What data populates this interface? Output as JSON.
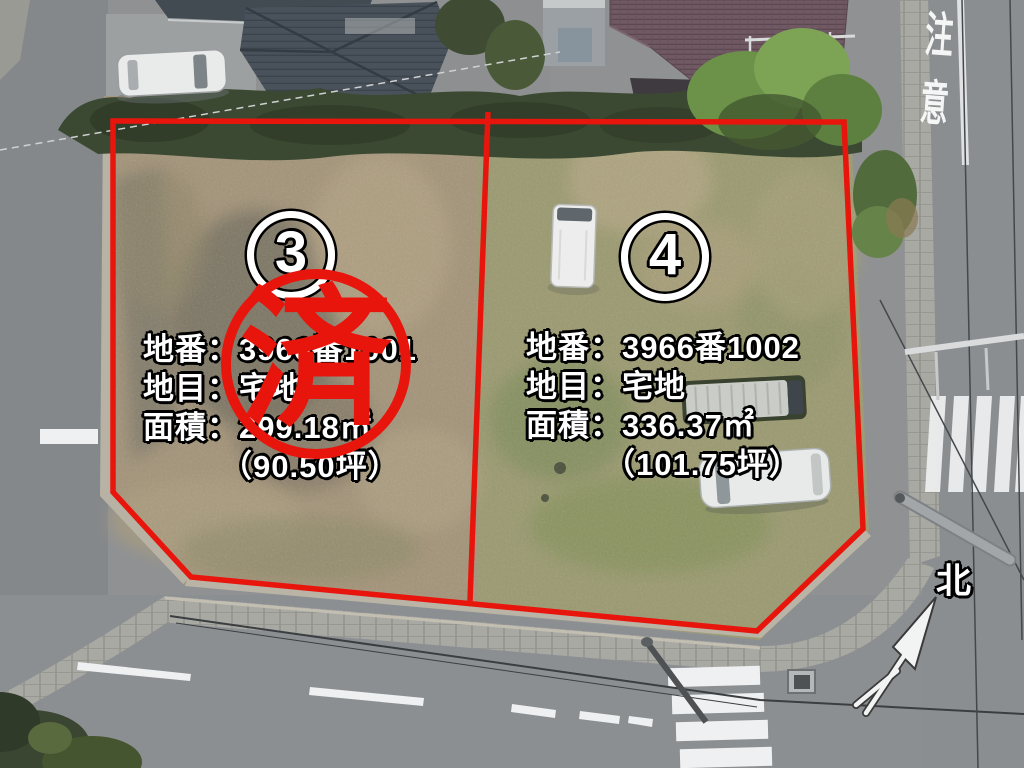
{
  "scene": {
    "description": "aerial drone photo of two residential lots for sale",
    "compass_label": "北",
    "road_caution_marking": "注意"
  },
  "colors": {
    "annotation_red": "#e8150d",
    "annotation_text": "#ffffff",
    "annotation_text_outline": "#000000"
  },
  "lots": [
    {
      "number": "3",
      "parcel_number_line": "地番：3966番1001",
      "land_category_line": "地目：宅地",
      "area_line": "面積：299.18㎡",
      "area_tsubo_line": "（90.50坪）",
      "sold": true,
      "status_stamp": "済"
    },
    {
      "number": "4",
      "parcel_number_line": "地番：3966番1002",
      "land_category_line": "地目：宅地",
      "area_line": "面積：336.37㎡",
      "area_tsubo_line": "（101.75坪）",
      "sold": false,
      "status_stamp": ""
    }
  ]
}
